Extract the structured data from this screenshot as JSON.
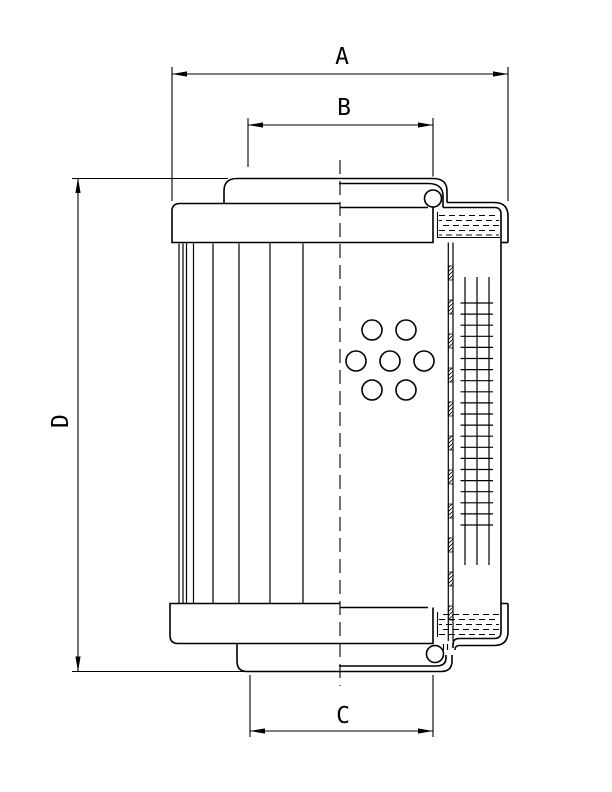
{
  "drawing": {
    "description": "filter-element-dimension-drawing",
    "dimensions": {
      "a": {
        "label": "A"
      },
      "b": {
        "label": "B"
      },
      "c": {
        "label": "C"
      },
      "d": {
        "label": "D"
      }
    },
    "colors": {
      "line": "#000000",
      "background": "#ffffff"
    }
  }
}
